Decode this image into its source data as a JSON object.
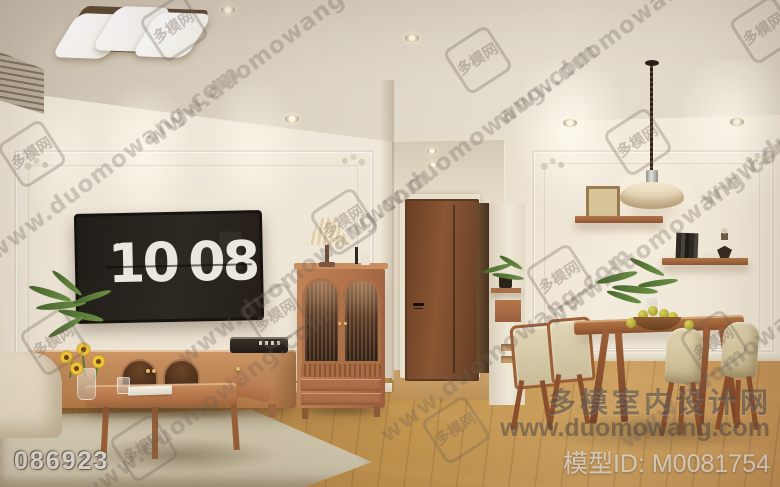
{
  "tv_clock": {
    "period": "AM",
    "hours": "10",
    "minutes": "08"
  },
  "watermarks": {
    "diagonal_text": "www.duomowang.com",
    "stamp_text": "多模网",
    "image_code": "086923",
    "site_name": "多模室内设计网",
    "site_url": "www.duomowang.com",
    "model_id": "模型ID: M0081754"
  },
  "colors": {
    "wall": "#ece4d5",
    "ceiling": "#ded5c6",
    "floor_wood": "#bc8d55",
    "door_wood": "#7b4a2b",
    "furniture_wood": "#bd8258",
    "tv_screen": "#26221d",
    "clock_digits": "#eae7e0",
    "rug": "#cfc5ae",
    "watermark_gray": "#6f6760",
    "fruit_yellow": "#c2b23d",
    "plant_green": "#5f7f3c"
  }
}
